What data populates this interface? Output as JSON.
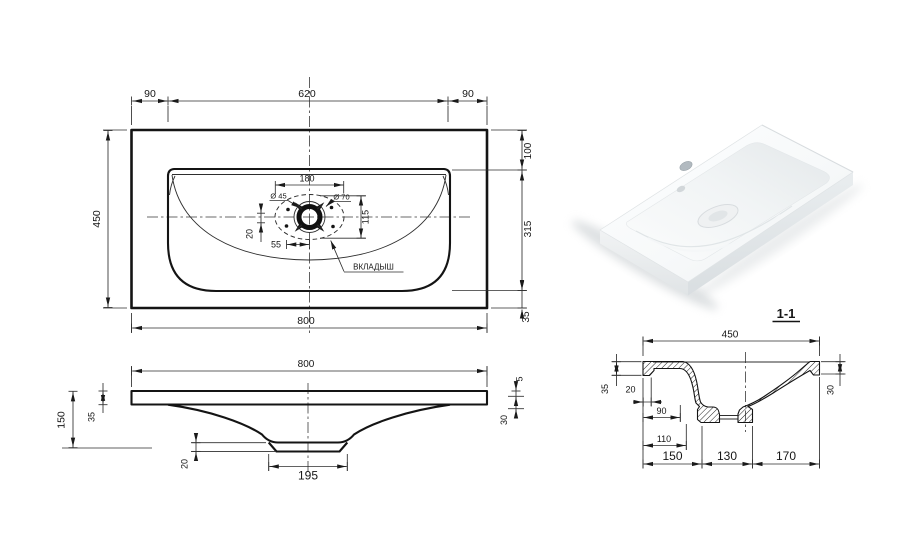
{
  "plan": {
    "dim_top_left": "90",
    "dim_top_center": "620",
    "dim_top_right": "90",
    "dim_left": "450",
    "dim_bottom": "800",
    "dim_right_top": "100",
    "dim_right_middle": "315",
    "dim_right_bottom": "35",
    "detail": {
      "dim_width": "180",
      "dia_small": "Ø 45",
      "dia_big": "Ø 70",
      "dim_height": "115",
      "dim_offset_v": "20",
      "dim_offset_h": "55",
      "callout": "ВКЛАДЫШ"
    }
  },
  "elevation": {
    "dim_width": "800",
    "dim_height": "150",
    "dim_slab": "35",
    "dim_lip": "5",
    "dim_edge": "30",
    "dim_boss": "20",
    "dim_drain_flat": "195"
  },
  "section": {
    "title": "1-1",
    "dim_width": "450",
    "dim_lip_h": "35",
    "dim_lip_w": "20",
    "dim_wall": "90",
    "dim_drain_left": "110",
    "dim_seg_left": "150",
    "dim_seg_mid": "130",
    "dim_seg_right": "170",
    "dim_lip_right": "30"
  },
  "colors": {
    "line": "#161616",
    "background": "#ffffff"
  }
}
